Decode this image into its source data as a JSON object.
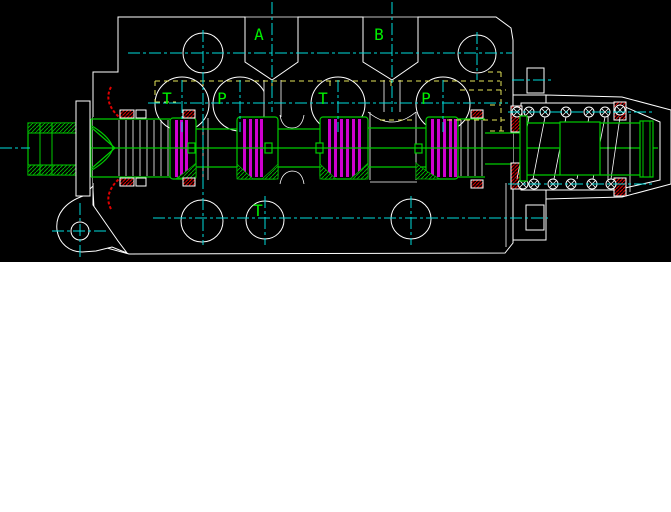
{
  "canvas": {
    "width": 671,
    "height": 512,
    "viewport_height": 262,
    "viewport_bg": "#000000",
    "page_bg": "#ffffff"
  },
  "drawing": {
    "type": "hydraulic-directional-valve-cross-section",
    "port_labels": {
      "a": "A",
      "b": "B",
      "t1": "T",
      "p1": "P",
      "t2": "T",
      "p2": "P",
      "t3": "T"
    },
    "colors": {
      "outline": "#ffffff",
      "body_hatch": "#d40000",
      "spool_geometry": "#00cc00",
      "port_label": "#00ee00",
      "seal_pack": "#cf00cf",
      "centerline": "#00dcdc",
      "selection_highlight": "#e6e65a",
      "seal_section": "#e00000"
    }
  }
}
